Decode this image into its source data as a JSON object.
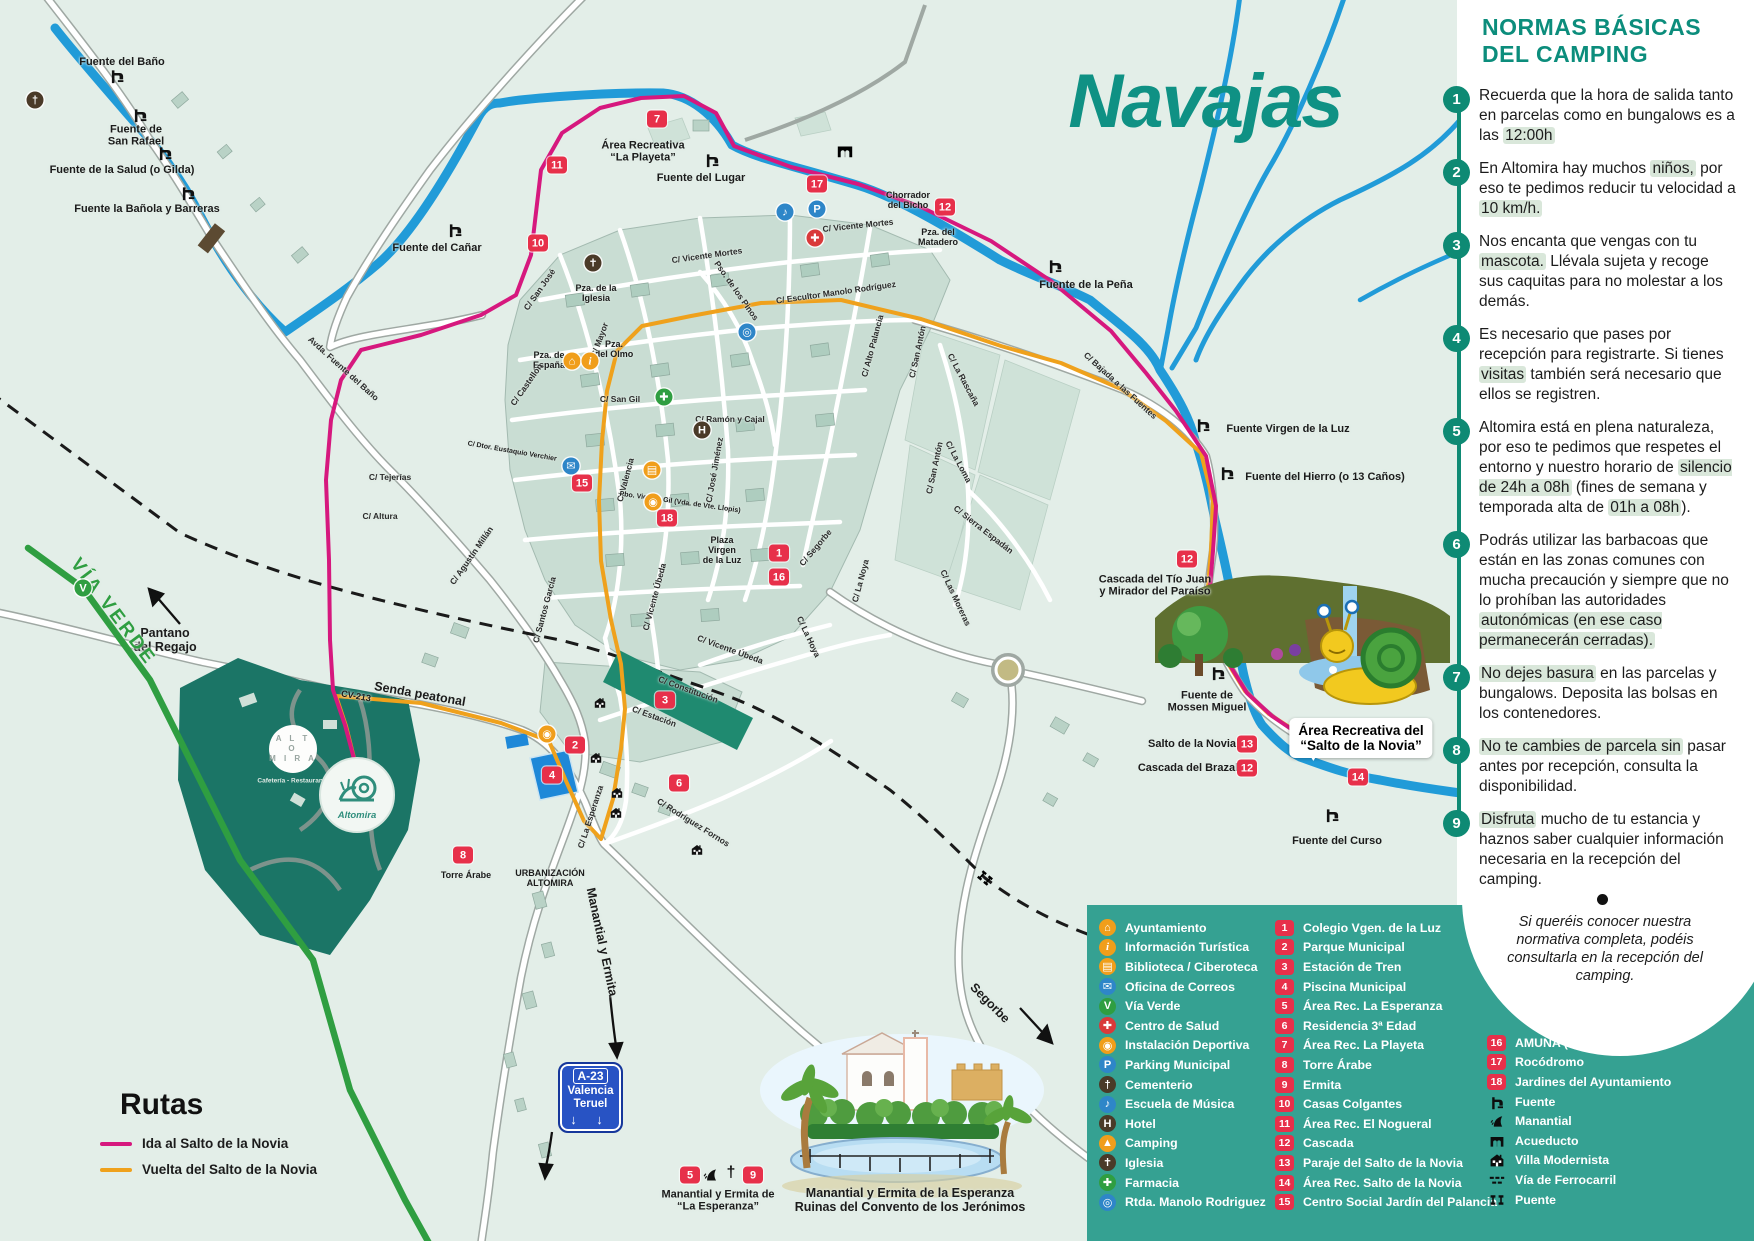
{
  "map": {
    "title": "Navajas",
    "callout": "Área Recreativa del\n“Salto de la Novia”",
    "labels": [
      {
        "t": "Fuente del Baño",
        "x": 122,
        "y": 62
      },
      {
        "t": "Fuente de\nSan Rafael",
        "x": 136,
        "y": 136
      },
      {
        "t": "Fuente de la Salud (o Gilda)",
        "x": 122,
        "y": 170
      },
      {
        "t": "Fuente la Bañola y Barreras",
        "x": 147,
        "y": 209
      },
      {
        "t": "Fuente del Cañar",
        "x": 437,
        "y": 248
      },
      {
        "t": "Fuente del Lugar",
        "x": 701,
        "y": 178
      },
      {
        "t": "Fuente de la Peña",
        "x": 1086,
        "y": 285
      },
      {
        "t": "Fuente Virgen de la Luz",
        "x": 1288,
        "y": 429
      },
      {
        "t": "Fuente del Hierro (o 13 Caños)",
        "x": 1325,
        "y": 477
      },
      {
        "t": "Fuente de\nMossen Miguel",
        "x": 1207,
        "y": 702
      },
      {
        "t": "Fuente del Curso",
        "x": 1337,
        "y": 841
      },
      {
        "t": "Cascada del Tío Juan\ny Mirador del Paraíso",
        "x": 1155,
        "y": 586
      },
      {
        "t": "Salto de la Novia",
        "x": 1192,
        "y": 744
      },
      {
        "t": "Cascada del Brazal",
        "x": 1188,
        "y": 768
      },
      {
        "t": "Chorrador\ndel Bicho",
        "x": 908,
        "y": 200,
        "cls": "xs"
      },
      {
        "t": "Pza. del\nMatadero",
        "x": 938,
        "y": 237,
        "cls": "xs"
      },
      {
        "t": "Área Recreativa\n“La Playeta”",
        "x": 643,
        "y": 152
      },
      {
        "t": "Pantano\ndel Regajo",
        "x": 165,
        "y": 640,
        "cls": "md"
      },
      {
        "t": "Senda peatonal",
        "x": 420,
        "y": 694,
        "r": 10,
        "cls": "md"
      },
      {
        "t": "CV-213",
        "x": 356,
        "y": 696,
        "r": 10,
        "cls": "xs"
      },
      {
        "t": "VÍA VERDE",
        "x": 113,
        "y": 612,
        "r": 53,
        "cls": "green"
      },
      {
        "t": "Segorbe",
        "x": 990,
        "y": 1003,
        "r": 45,
        "cls": "md"
      },
      {
        "t": "Torre Árabe",
        "x": 466,
        "y": 875,
        "cls": "xs"
      },
      {
        "t": "URBANIZACIÓN\nALTOMIRA",
        "x": 550,
        "y": 878,
        "cls": "xs"
      },
      {
        "t": "Manantial y Ermita",
        "x": 602,
        "y": 942,
        "r": 78,
        "cls": "md"
      },
      {
        "t": "Avda. Fuente del Baño",
        "x": 343,
        "y": 369,
        "r": 42,
        "cls": "st"
      },
      {
        "t": "C/ Vicente Mortes",
        "x": 707,
        "y": 256,
        "r": -8,
        "cls": "st"
      },
      {
        "t": "C/ Vicente Mortes",
        "x": 858,
        "y": 226,
        "r": -6,
        "cls": "st"
      },
      {
        "t": "Pso. de los Pinos",
        "x": 736,
        "y": 291,
        "r": 55,
        "cls": "st"
      },
      {
        "t": "C/ Escultor Manolo Rodríguez",
        "x": 836,
        "y": 293,
        "r": -8,
        "cls": "st"
      },
      {
        "t": "C/ Alto Palancia",
        "x": 873,
        "y": 346,
        "r": -75,
        "cls": "st"
      },
      {
        "t": "C/ San Antón",
        "x": 918,
        "y": 352,
        "r": -78,
        "cls": "st"
      },
      {
        "t": "C/ San Antón",
        "x": 935,
        "y": 468,
        "r": -78,
        "cls": "st"
      },
      {
        "t": "C/ La Rascaña",
        "x": 963,
        "y": 380,
        "r": 62,
        "cls": "st"
      },
      {
        "t": "C/ La Loma",
        "x": 958,
        "y": 462,
        "r": 62,
        "cls": "st"
      },
      {
        "t": "C/ Sierra Espadán",
        "x": 983,
        "y": 530,
        "r": 38,
        "cls": "st"
      },
      {
        "t": "C/ Las Moreras",
        "x": 955,
        "y": 598,
        "r": 65,
        "cls": "st"
      },
      {
        "t": "C/ Bajada a las Fuentes",
        "x": 1120,
        "y": 386,
        "r": 42,
        "cls": "st"
      },
      {
        "t": "C/ Segorbe",
        "x": 816,
        "y": 548,
        "r": -50,
        "cls": "st"
      },
      {
        "t": "C/ La Noya",
        "x": 861,
        "y": 581,
        "r": -75,
        "cls": "st"
      },
      {
        "t": "C/ Ramón y Cajal",
        "x": 730,
        "y": 420,
        "cls": "st"
      },
      {
        "t": "C/ San Gil",
        "x": 620,
        "y": 400,
        "cls": "st"
      },
      {
        "t": "C/ José Jiménez",
        "x": 715,
        "y": 470,
        "r": -80,
        "cls": "st"
      },
      {
        "t": "C/ Valencia",
        "x": 626,
        "y": 480,
        "r": -75,
        "cls": "st"
      },
      {
        "t": "C/ Mayor",
        "x": 600,
        "y": 340,
        "r": -70,
        "cls": "st"
      },
      {
        "t": "C/ San José",
        "x": 540,
        "y": 290,
        "r": -55,
        "cls": "st"
      },
      {
        "t": "Pza. de la\nIglesia",
        "x": 596,
        "y": 293,
        "cls": "xs"
      },
      {
        "t": "Pza. de\nEspaña",
        "x": 549,
        "y": 360,
        "cls": "xs"
      },
      {
        "t": "Pza.\ndel Olmo",
        "x": 614,
        "y": 349,
        "cls": "xs"
      },
      {
        "t": "C/ Castellón",
        "x": 527,
        "y": 385,
        "r": -55,
        "cls": "st"
      },
      {
        "t": "C/ Tejerías",
        "x": 390,
        "y": 478,
        "cls": "st"
      },
      {
        "t": "C/ Altura",
        "x": 380,
        "y": 517,
        "cls": "st"
      },
      {
        "t": "C/ Agustín Millán",
        "x": 472,
        "y": 556,
        "r": -55,
        "cls": "st"
      },
      {
        "t": "C/ Santos García",
        "x": 545,
        "y": 610,
        "r": -75,
        "cls": "st"
      },
      {
        "t": "C/ Dtor. Eustaquio Verchier",
        "x": 512,
        "y": 452,
        "r": 10,
        "cls": "xxs"
      },
      {
        "t": "Pbo. Vicente Gil (Vda. de Vte. Llopis)",
        "x": 680,
        "y": 503,
        "r": 8,
        "cls": "xxs"
      },
      {
        "t": "C/ Constitución",
        "x": 688,
        "y": 690,
        "r": 20,
        "cls": "st"
      },
      {
        "t": "C/ Estación",
        "x": 654,
        "y": 717,
        "r": 20,
        "cls": "st"
      },
      {
        "t": "C/ Vicente Úbeda",
        "x": 730,
        "y": 650,
        "r": 20,
        "cls": "st"
      },
      {
        "t": "C/ Vicente Úbeda",
        "x": 655,
        "y": 597,
        "r": -75,
        "cls": "st"
      },
      {
        "t": "C/ La Hoya",
        "x": 808,
        "y": 637,
        "r": 65,
        "cls": "st"
      },
      {
        "t": "C/ Rodríguez Fornos",
        "x": 693,
        "y": 823,
        "r": 32,
        "cls": "st"
      },
      {
        "t": "C/ La Esperanza",
        "x": 591,
        "y": 817,
        "r": -72,
        "cls": "st"
      },
      {
        "t": "Plaza\nVirgen\nde la Luz",
        "x": 722,
        "y": 550,
        "cls": "xs"
      },
      {
        "t": "Manantial y Ermita de\n“La Esperanza”",
        "x": 718,
        "y": 1201
      },
      {
        "t": "Manantial y Ermita de la Esperanza\nRuinas del Convento de los Jerónimos",
        "x": 910,
        "y": 1200,
        "cls": "md"
      }
    ],
    "badges": [
      {
        "n": "7",
        "x": 657,
        "y": 119
      },
      {
        "n": "11",
        "x": 557,
        "y": 165
      },
      {
        "n": "17",
        "x": 817,
        "y": 184
      },
      {
        "n": "12",
        "x": 945,
        "y": 207
      },
      {
        "n": "10",
        "x": 538,
        "y": 243
      },
      {
        "n": "15",
        "x": 582,
        "y": 483
      },
      {
        "n": "18",
        "x": 667,
        "y": 518
      },
      {
        "n": "1",
        "x": 779,
        "y": 553
      },
      {
        "n": "16",
        "x": 779,
        "y": 577
      },
      {
        "n": "12",
        "x": 1187,
        "y": 559
      },
      {
        "n": "3",
        "x": 665,
        "y": 700
      },
      {
        "n": "2",
        "x": 575,
        "y": 745
      },
      {
        "n": "4",
        "x": 552,
        "y": 775
      },
      {
        "n": "6",
        "x": 679,
        "y": 783
      },
      {
        "n": "8",
        "x": 463,
        "y": 855
      },
      {
        "n": "13",
        "x": 1247,
        "y": 744
      },
      {
        "n": "12",
        "x": 1247,
        "y": 768
      },
      {
        "n": "14",
        "x": 1358,
        "y": 777
      },
      {
        "n": "5",
        "x": 690,
        "y": 1175
      },
      {
        "n": "9",
        "x": 753,
        "y": 1175
      }
    ],
    "pois": [
      {
        "name": "cementerio-icon",
        "g": "†",
        "bg": "#4a3a28",
        "x": 35,
        "y": 100
      },
      {
        "name": "iglesia-icon",
        "g": "✝",
        "bg": "#4a3a28",
        "x": 593,
        "y": 263
      },
      {
        "name": "musica-icon",
        "g": "♪",
        "bg": "#2e86c8",
        "x": 785,
        "y": 212
      },
      {
        "name": "parking-icon",
        "g": "P",
        "bg": "#2e86c8",
        "x": 817,
        "y": 209
      },
      {
        "name": "salud-icon",
        "g": "✚",
        "bg": "#d93a3a",
        "x": 815,
        "y": 238
      },
      {
        "name": "rotonda-icon",
        "g": "◎",
        "bg": "#2e86c8",
        "x": 747,
        "y": 332
      },
      {
        "name": "ayuntamiento-icon",
        "g": "⌂",
        "bg": "#f09e1b",
        "x": 572,
        "y": 361
      },
      {
        "name": "info-icon",
        "g": "i",
        "bg": "#f09e1b",
        "x": 590,
        "y": 361,
        "it": true
      },
      {
        "name": "farmacia-icon",
        "g": "✚",
        "bg": "#2f9e41",
        "x": 664,
        "y": 397
      },
      {
        "name": "hotel-icon",
        "g": "H",
        "bg": "#4a3a28",
        "x": 702,
        "y": 430
      },
      {
        "name": "correos-icon",
        "g": "✉",
        "bg": "#2e86c8",
        "x": 571,
        "y": 466
      },
      {
        "name": "biblioteca-icon",
        "g": "▤",
        "bg": "#f09e1b",
        "x": 652,
        "y": 470
      },
      {
        "name": "deportiva-icon",
        "g": "◉",
        "bg": "#f09e1b",
        "x": 653,
        "y": 502
      },
      {
        "name": "deportiva-icon",
        "g": "◉",
        "bg": "#f09e1b",
        "x": 547,
        "y": 734
      },
      {
        "name": "viaverde-icon",
        "g": "V",
        "bg": "#2f9e41",
        "x": 83,
        "y": 588
      },
      {
        "name": "manantial-icon",
        "g": "",
        "sym": "manantial",
        "x": 710,
        "y": 1174,
        "plain": true
      },
      {
        "name": "cross-icon",
        "g": "†",
        "x": 731,
        "y": 1173,
        "plain": true
      }
    ],
    "fuentes": [
      {
        "x": 117,
        "y": 78
      },
      {
        "x": 140,
        "y": 117
      },
      {
        "x": 165,
        "y": 155
      },
      {
        "x": 188,
        "y": 195
      },
      {
        "x": 455,
        "y": 232
      },
      {
        "x": 712,
        "y": 162
      },
      {
        "x": 1055,
        "y": 268
      },
      {
        "x": 1203,
        "y": 427
      },
      {
        "x": 1227,
        "y": 475
      },
      {
        "x": 1218,
        "y": 675
      },
      {
        "x": 1332,
        "y": 817
      }
    ],
    "villas": [
      {
        "x": 600,
        "y": 705
      },
      {
        "x": 596,
        "y": 760
      },
      {
        "x": 617,
        "y": 795
      },
      {
        "x": 616,
        "y": 815
      },
      {
        "x": 697,
        "y": 852
      }
    ]
  },
  "camping": {
    "logo1_text": "A L T O\nM I R A",
    "logo1_sub": "Cafetería - Restaurante",
    "logo2_text": "Altomira"
  },
  "sign_a23": {
    "code": "A-23",
    "line1": "Valencia",
    "line2": "Teruel",
    "arrows": "↓ ↓"
  },
  "rutas": {
    "title": "Rutas",
    "items": [
      {
        "label": "Ida al Salto de la Novia",
        "color": "#d6187e"
      },
      {
        "label": "Vuelta del Salto de la Novia",
        "color": "#efa11c"
      }
    ]
  },
  "rules": {
    "title_line1": "NORMAS BÁSICAS",
    "title_line2": "DEL CAMPING",
    "items": [
      {
        "n": "1",
        "text": "Recuerda que la hora de salida tanto en parcelas como en bungalows es a las «12:00h»"
      },
      {
        "n": "2",
        "text": "En Altomira hay muchos «niños,» por eso te pedimos reducir tu velocidad a «10 km/h.»"
      },
      {
        "n": "3",
        "text": "Nos encanta que vengas con tu «mascota.» Llévala sujeta y recoge sus caquitas para no molestar a los demás."
      },
      {
        "n": "4",
        "text": "Es necesario que pases por recepción para registrarte. Si tienes «visitas» también será necesario que ellos se registren."
      },
      {
        "n": "5",
        "text": "Altomira está en plena naturaleza, por eso te pedimos que respetes el entorno y nuestro horario de «silencio de 24h a 08h» (fines de semana y temporada alta de «01h a 08h»)."
      },
      {
        "n": "6",
        "text": "Podrás utilizar las barbacoas que están en las zonas comunes con mucha precaución y siempre que no lo prohíban las autoridades «autonómicas (en ese caso permanecerán cerradas).»"
      },
      {
        "n": "7",
        "text": "«No dejes basura» en las parcelas y bungalows. Deposita las bolsas en los contenedores."
      },
      {
        "n": "8",
        "text": "«No te cambies de parcela sin» pasar antes por recepción, consulta la disponibilidad."
      },
      {
        "n": "9",
        "text": "«Disfruta» mucho de tu estancia y haznos saber cualquier información necesaria en la recepción del camping."
      }
    ],
    "note": "Si queréis conocer nuestra normativa completa, podéis consultarla en la recepción del camping."
  },
  "legend": {
    "col1": [
      {
        "label": "Ayuntamiento",
        "g": "⌂",
        "bg": "#f09e1b"
      },
      {
        "label": "Información Turística",
        "g": "i",
        "bg": "#f09e1b",
        "it": true
      },
      {
        "label": "Biblioteca / Ciberoteca",
        "g": "▤",
        "bg": "#f09e1b"
      },
      {
        "label": "Oficina de Correos",
        "g": "✉",
        "bg": "#2e86c8"
      },
      {
        "label": "Vía Verde",
        "g": "V",
        "bg": "#2f9e41"
      },
      {
        "label": "Centro de Salud",
        "g": "✚",
        "bg": "#d93a3a"
      },
      {
        "label": "Instalación Deportiva",
        "g": "◉",
        "bg": "#f09e1b"
      },
      {
        "label": "Parking Municipal",
        "g": "P",
        "bg": "#2e86c8"
      },
      {
        "label": "Cementerio",
        "g": "†",
        "bg": "#4a3a28"
      },
      {
        "label": "Escuela de Música",
        "g": "♪",
        "bg": "#2e86c8"
      },
      {
        "label": "Hotel",
        "g": "H",
        "bg": "#4a3a28"
      },
      {
        "label": "Camping",
        "g": "▲",
        "bg": "#f09e1b"
      },
      {
        "label": "Iglesia",
        "g": "✝",
        "bg": "#4a3a28"
      },
      {
        "label": "Farmacia",
        "g": "✚",
        "bg": "#2f9e41"
      },
      {
        "label": "Rtda. Manolo Rodriguez",
        "g": "◎",
        "bg": "#2e86c8"
      }
    ],
    "col2": [
      {
        "n": "1",
        "label": "Colegio Vgen. de la Luz"
      },
      {
        "n": "2",
        "label": "Parque Municipal"
      },
      {
        "n": "3",
        "label": "Estación de Tren"
      },
      {
        "n": "4",
        "label": "Piscina Municipal"
      },
      {
        "n": "5",
        "label": "Área Rec. La Esperanza"
      },
      {
        "n": "6",
        "label": "Residencia 3ª Edad"
      },
      {
        "n": "7",
        "label": "Área Rec. La Playeta"
      },
      {
        "n": "8",
        "label": "Torre Árabe"
      },
      {
        "n": "9",
        "label": "Ermita"
      },
      {
        "n": "10",
        "label": "Casas Colgantes"
      },
      {
        "n": "11",
        "label": "Área Rec. El Nogueral"
      },
      {
        "n": "12",
        "label": "Cascada"
      },
      {
        "n": "13",
        "label": "Paraje del Salto de la Novia"
      },
      {
        "n": "14",
        "label": "Área Rec. Salto de la Novia"
      },
      {
        "n": "15",
        "label": "Centro Social Jardín del Palancia"
      }
    ],
    "col3": [
      {
        "n": "16",
        "label": "AMUNA (Auditorio)"
      },
      {
        "n": "17",
        "label": "Rocódromo"
      },
      {
        "n": "18",
        "label": "Jardines del Ayuntamiento"
      }
    ],
    "col3_symbols": [
      {
        "label": "Fuente",
        "sym": "fuente"
      },
      {
        "label": "Manantial",
        "sym": "manantial"
      },
      {
        "label": "Acueducto",
        "sym": "acueducto"
      },
      {
        "label": "Villa Modernista",
        "sym": "villa"
      },
      {
        "label": "Vía de Ferrocarril",
        "sym": "rail"
      },
      {
        "label": "Puente",
        "sym": "puente"
      }
    ]
  }
}
